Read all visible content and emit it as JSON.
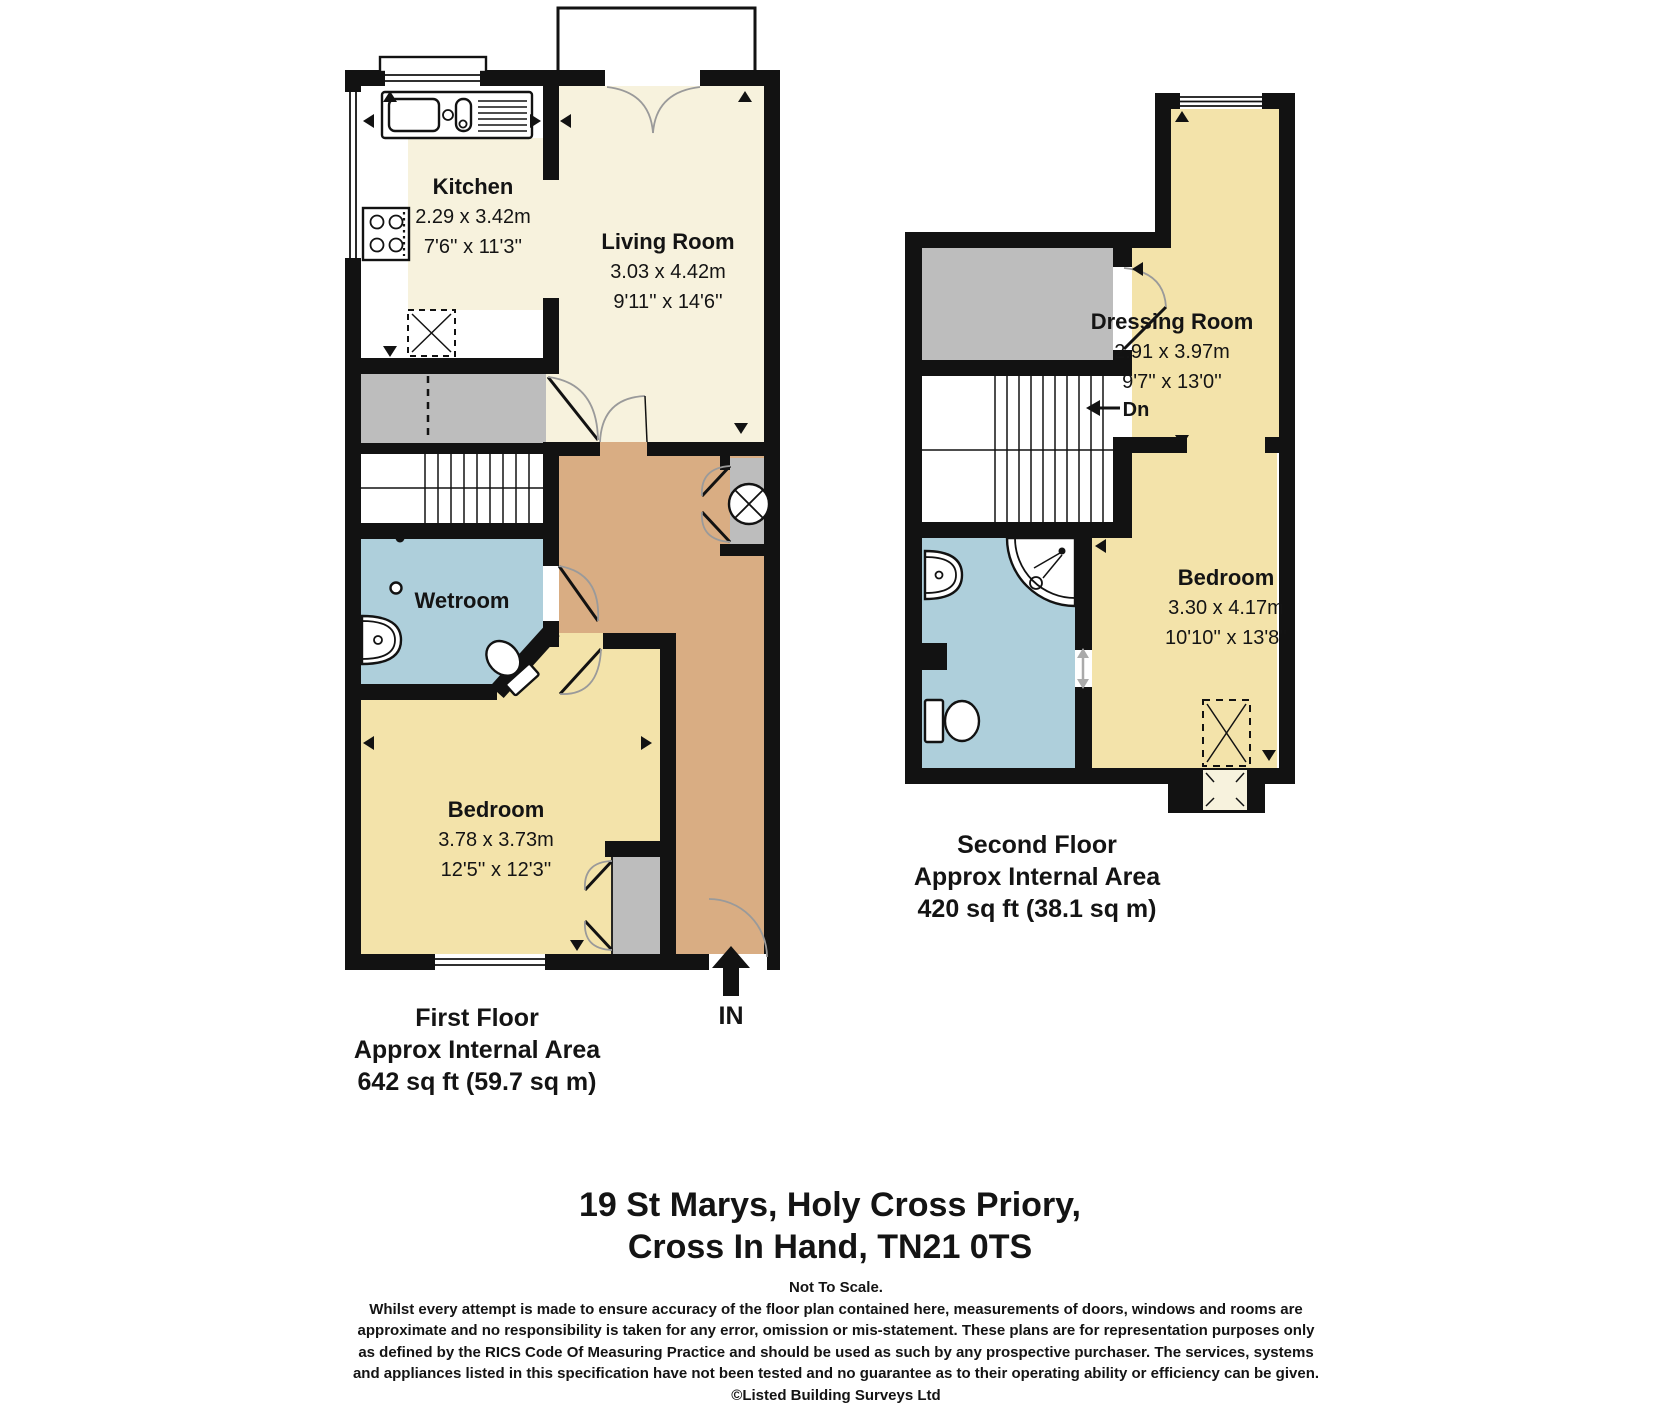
{
  "floors": {
    "first": {
      "caption": {
        "line1": "First Floor",
        "line2": "Approx Internal Area",
        "line3": "642 sq ft (59.7 sq m)"
      },
      "entrance_label": "IN",
      "rooms": {
        "kitchen": {
          "name": "Kitchen",
          "size_metric": "2.29 x 3.42m",
          "size_imperial": "7'6'' x 11'3''"
        },
        "living_room": {
          "name": "Living Room",
          "size_metric": "3.03 x 4.42m",
          "size_imperial": "9'11'' x 14'6''"
        },
        "wetroom": {
          "name": "Wetroom"
        },
        "bedroom": {
          "name": "Bedroom",
          "size_metric": "3.78 x 3.73m",
          "size_imperial": "12'5'' x 12'3''"
        }
      }
    },
    "second": {
      "caption": {
        "line1": "Second Floor",
        "line2": "Approx Internal Area",
        "line3": "420 sq ft (38.1 sq m)"
      },
      "stairs_label": "Dn",
      "rooms": {
        "dressing_room": {
          "name": "Dressing Room",
          "size_metric": "2.91 x 3.97m",
          "size_imperial": "9'7'' x 13'0''"
        },
        "bedroom": {
          "name": "Bedroom",
          "size_metric": "3.30 x 4.17m",
          "size_imperial": "10'10'' x 13'8''"
        }
      }
    }
  },
  "address": {
    "line1": "19 St Marys, Holy Cross Priory,",
    "line2": "Cross In Hand, TN21 0TS"
  },
  "disclaimer": {
    "scale_note": "Not To Scale.",
    "lines": [
      "Whilst every attempt is made to ensure accuracy of the floor plan contained here, measurements of doors, windows and rooms are",
      "approximate and no responsibility is taken for any error, omission or mis-statement. These plans are for representation purposes only",
      "as defined by the RICS Code Of Measuring Practice and should be used as such by any prospective purchaser. The services, systems",
      "and appliances listed in this specification have not been tested and no guarantee as to their operating ability or efficiency can be given."
    ],
    "copyright": "©Listed Building Surveys Ltd"
  },
  "colors": {
    "room_cream": "#f7f2dd",
    "room_yellow": "#f3e3aa",
    "wet_blue": "#aecfdb",
    "hall_tan": "#d9ad83",
    "storage_gray": "#bdbdbd",
    "wall_black": "#121212"
  }
}
